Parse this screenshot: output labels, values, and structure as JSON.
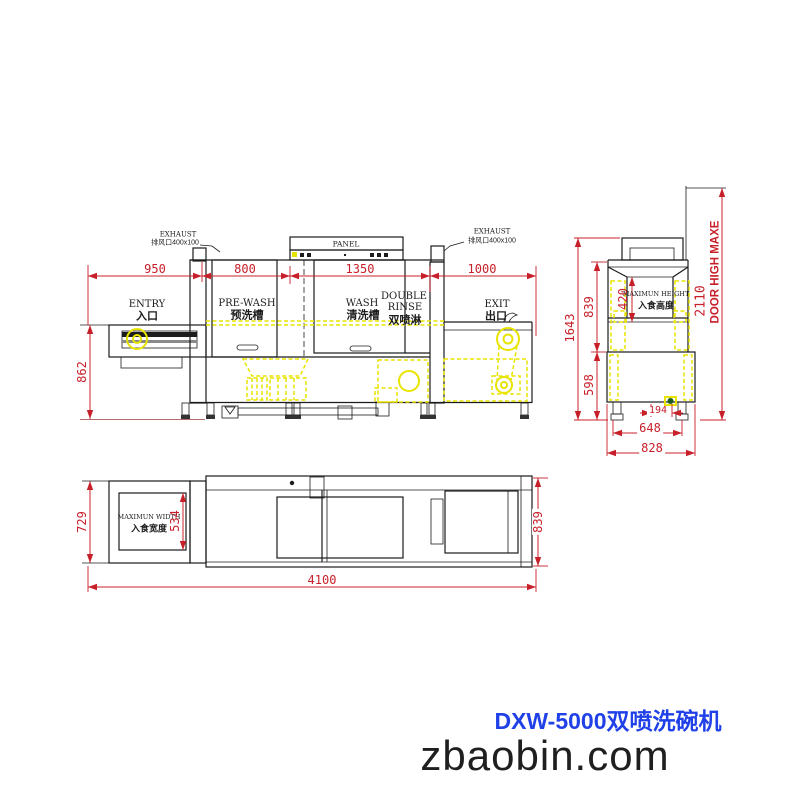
{
  "page": {
    "title": "DXW-5000双喷洗碗机",
    "website": "zbaobin.com"
  },
  "colors": {
    "dimension": "#c8202a",
    "line": "#1c1c1c",
    "highlight": "#e8e400",
    "brand_blue": "#2141e8",
    "brand_dark": "#1f1f1f"
  },
  "side_view": {
    "exhaust_left_en": "EXHAUST",
    "exhaust_left_zh": "排风口400x100",
    "exhaust_right_en": "EXHAUST",
    "exhaust_right_zh": "排风口400x100",
    "panel": "PANEL",
    "entry_en": "ENTRY",
    "entry_zh": "入口",
    "prewash_en": "PRE-WASH",
    "prewash_zh": "预洗槽",
    "wash_en": "WASH",
    "wash_zh": "清洗槽",
    "rinse_en1": "DOUBLE",
    "rinse_en2": "RINSE",
    "rinse_zh": "双喷淋",
    "exit_en": "EXIT",
    "exit_zh": "出口",
    "dim_entry": "950",
    "dim_prewash": "800",
    "dim_wash": "1350",
    "dim_exit": "1000",
    "dim_table_height": "862"
  },
  "end_view": {
    "dim_total_height": "1643",
    "dim_tunnel_height": "839",
    "dim_body_height": "598",
    "dim_opening_height": "420",
    "dim_door_open": "2110",
    "dim_drain": "194",
    "dim_leg_span": "648",
    "dim_body_width": "828",
    "door_note": "DOOR HIGH MAXE",
    "opening_en": "MAXIMUN HEIGHT",
    "opening_zh": "入食高度"
  },
  "plan_view": {
    "dim_table_width": "729",
    "dim_opening_width": "534",
    "dim_body_width": "839",
    "dim_total_length": "4100",
    "opening_en": "MAXIMUN WIDTH",
    "opening_zh": "入食宽度"
  }
}
